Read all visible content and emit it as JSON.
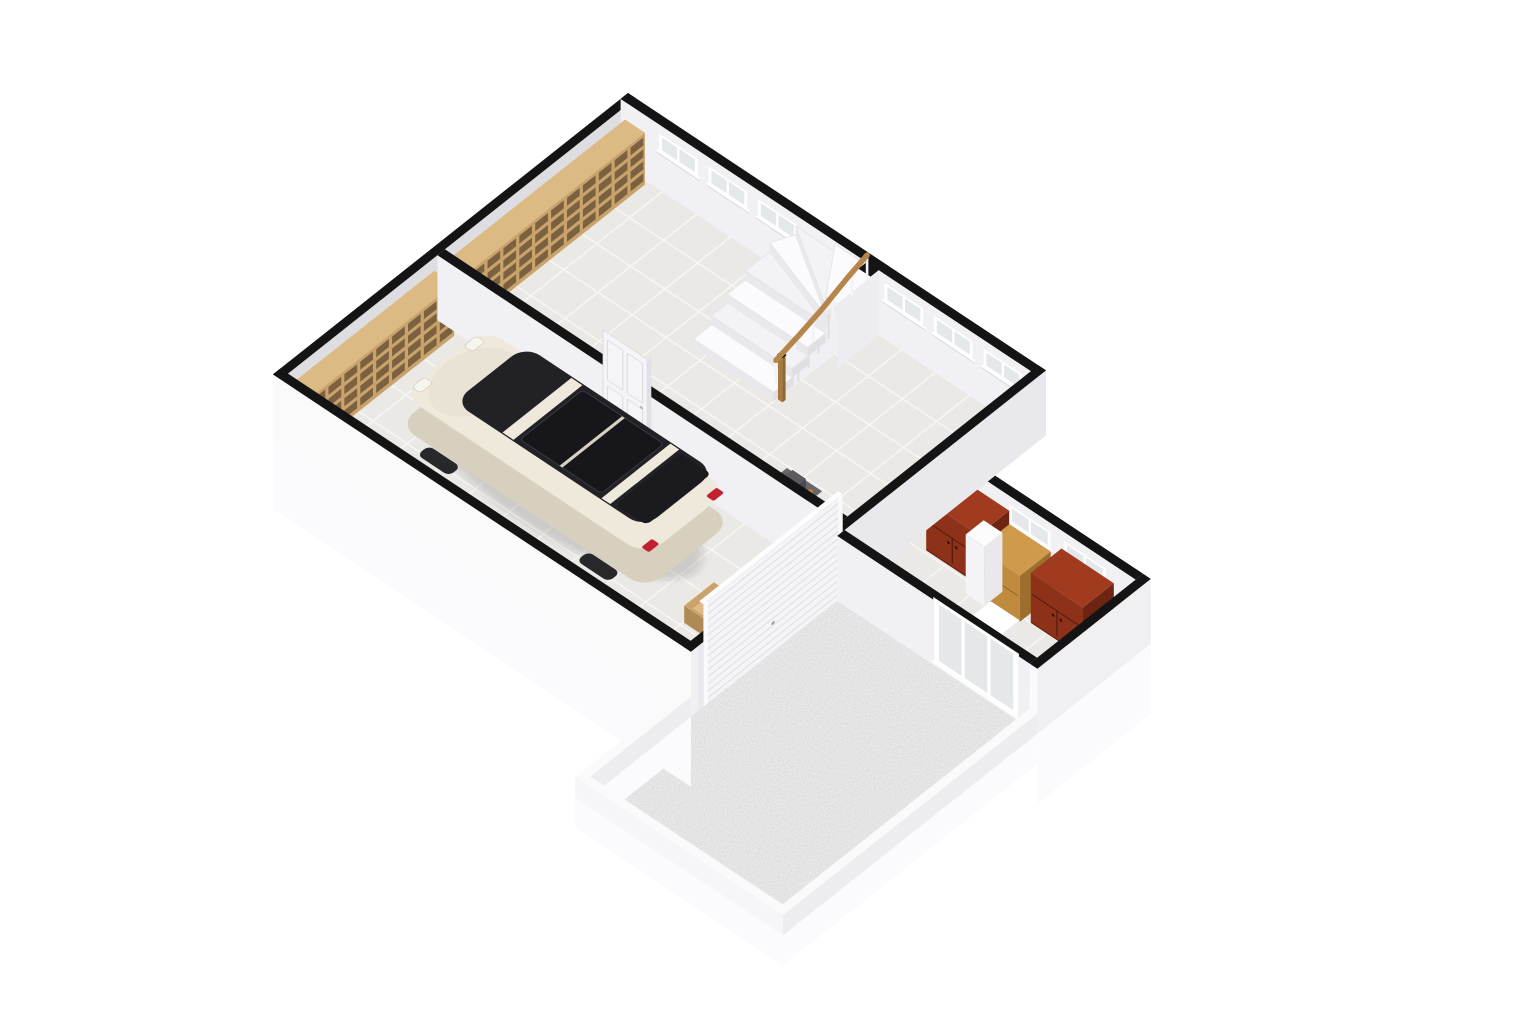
{
  "meta": {
    "label": "3D isometric floor plan render - basement level with garage, hall staircase, storage room and gravel courtyard"
  },
  "projection": {
    "ox": 628,
    "oy": 158,
    "ux": 0.55,
    "uy": 0.365,
    "vx": -0.53,
    "vy": 0.42,
    "wz": 0.5
  },
  "palette": {
    "bg": "#ffffff",
    "wallTop": "#141414",
    "wallInA": "#dedde2",
    "wallInB": "#f1f0f4",
    "wallInX": "#e9e8ec",
    "wallOutY": "#fafafa",
    "wallOutX": "#f0f0f3",
    "skirt": "#fbfbfd",
    "lowTop": "#fafafb",
    "lowFaceY": "#f6f6f8",
    "lowFaceX": "#ededf0",
    "floor": "#ebe9e6",
    "grout": "#f8f7f4",
    "gravelBase": "#e4e4e4",
    "gravelDot": "#8c8c8f",
    "wood": "#c9a36b",
    "woodTop": "#dcba84",
    "woodDark": "#7b6140",
    "woodSide": "#b08a54",
    "crateIn": "#ddbb88",
    "oakTop": "#cf9a4b",
    "oakFront": "#c08b3c",
    "oakSide": "#9c6f2e",
    "redTop": "#a03b20",
    "redFront": "#8e3119",
    "redSide": "#6e2412",
    "redSeam": "#571c0e",
    "doorWhite": "#f5f5f8",
    "doorLine": "#d8d8dd",
    "stairTread": "#fbfbfd",
    "stairTread2": "#f3f3f6",
    "stairRiser": "#e9e9ed",
    "stairSide": "#dfdfe4",
    "stairPanel": "#f0f0f4",
    "rail": "#b5854a",
    "newel": "#a87a3e",
    "carBody": "#efe9dc",
    "carLower": "#d8d0bf",
    "carGlass": "#212126",
    "carGlass2": "#17171b",
    "carShadow": "rgba(40,40,45,0.16)",
    "tail": "#c3212f",
    "metal": "#b9bac0",
    "metalDark": "#8e8f95",
    "tableTop": "#66666b",
    "white": "#ffffff",
    "paneGlass": "#e4e8eb",
    "pillarTop": "#fcfcfd",
    "pillarX": "#e9e9ed",
    "pillarY": "#f4f4f7"
  },
  "scene": {
    "floors": [
      {
        "name": "hall-floor",
        "kind": "tile",
        "x": [
          14,
          746
        ],
        "y": [
          14,
          360
        ]
      },
      {
        "name": "garage-floor",
        "kind": "tile",
        "x": [
          14,
          746
        ],
        "y": [
          374,
          656
        ]
      },
      {
        "name": "storage-floor",
        "kind": "tile",
        "x": [
          760,
          1110
        ],
        "y": [
          194,
          380
        ]
      },
      {
        "name": "courtyard-gravel",
        "kind": "gravel",
        "x": [
          760,
          1110
        ],
        "y": [
          394,
          860
        ]
      }
    ],
    "walls": [
      {
        "name": "exterior-wall-left",
        "axis": "x",
        "x": [
          0,
          14
        ],
        "y": [
          0,
          670
        ],
        "h": 130,
        "face": "wallInA",
        "cap": "wallOutY"
      },
      {
        "name": "exterior-wall-top",
        "axis": "y",
        "y": [
          0,
          14
        ],
        "x": [
          0,
          760
        ],
        "h": 130,
        "face": "wallInB",
        "cap": "wallInX",
        "windows": [
          [
            70,
            140
          ],
          [
            160,
            230
          ],
          [
            250,
            320
          ],
          [
            480,
            550
          ],
          [
            570,
            640
          ],
          [
            660,
            730
          ]
        ],
        "winZ": [
          78,
          112
        ]
      },
      {
        "name": "interior-wall-hall-garage",
        "axis": "y",
        "y": [
          360,
          374
        ],
        "x": [
          14,
          746
        ],
        "h": 130,
        "face": "wallInB"
      },
      {
        "name": "storage-wall-north",
        "axis": "y",
        "y": [
          180,
          194
        ],
        "x": [
          760,
          1110
        ],
        "h": 130,
        "face": "wallInB",
        "windows": [
          [
            880,
            955
          ],
          [
            980,
            1055
          ]
        ],
        "winZ": [
          78,
          112
        ]
      },
      {
        "name": "wall-east-spine",
        "axis": "x",
        "x": [
          746,
          760
        ],
        "y": [
          0,
          670
        ],
        "h": 130,
        "face": "wallInX",
        "cap": "wallOutY"
      },
      {
        "name": "storage-wall-south",
        "axis": "y",
        "y": [
          380,
          394
        ],
        "x": [
          760,
          1110
        ],
        "h": 130,
        "face": "wallInB"
      },
      {
        "name": "storage-wall-east",
        "axis": "x",
        "x": [
          1110,
          1124
        ],
        "y": [
          180,
          394
        ],
        "h": 130,
        "face": "wallOutX",
        "cap": "wallOutY",
        "skirt": -140
      },
      {
        "name": "garage-front-wall",
        "axis": "y",
        "y": [
          656,
          670
        ],
        "x": [
          0,
          760
        ],
        "h": 130,
        "face": "wallOutY",
        "cap": "wallOutX",
        "skirt": -140
      },
      {
        "name": "courtyard-wall-west",
        "axis": "x",
        "x": [
          746,
          760
        ],
        "y": [
          670,
          860
        ],
        "h": 40,
        "face": "lowFaceX",
        "top": "lowTop",
        "skirt": -60
      },
      {
        "name": "courtyard-wall-south",
        "axis": "y",
        "y": [
          860,
          874
        ],
        "x": [
          746,
          1124
        ],
        "h": 40,
        "face": "lowFaceY",
        "top": "lowTop",
        "skirt": -60
      },
      {
        "name": "courtyard-wall-east",
        "axis": "x",
        "x": [
          1110,
          1124
        ],
        "y": [
          394,
          874
        ],
        "h": 40,
        "face": "lowFaceX",
        "top": "lowTop",
        "skirt": -60
      }
    ],
    "furniture": {
      "hall-shelving": {
        "type": "shelf",
        "x": [
          14,
          50
        ],
        "y": [
          20,
          350
        ],
        "h": 104,
        "rows": 4,
        "cols": 11
      },
      "garage-shelving": {
        "type": "shelf",
        "x": [
          14,
          50
        ],
        "y": [
          380,
          650
        ],
        "h": 104,
        "rows": 4,
        "cols": 9
      },
      "staircase": {
        "type": "stairs",
        "straight": [
          {
            "r": [
              302,
              152,
              448,
              190
            ],
            "z": 18
          },
          {
            "r": [
              302,
              122,
              448,
              156
            ],
            "z": 36
          },
          {
            "r": [
              302,
              92,
              448,
              126
            ],
            "z": 54
          }
        ],
        "fan": [
          {
            "pts": [
              [
                448,
                92
              ],
              [
                302,
                92
              ],
              [
                302,
                46
              ]
            ],
            "z": 72
          },
          {
            "pts": [
              [
                448,
                92
              ],
              [
                302,
                46
              ],
              [
                318,
                14
              ]
            ],
            "z": 90
          },
          {
            "pts": [
              [
                448,
                92
              ],
              [
                318,
                14
              ],
              [
                390,
                14
              ]
            ],
            "z": 108
          },
          {
            "pts": [
              [
                448,
                92
              ],
              [
                390,
                14
              ],
              [
                448,
                14
              ]
            ],
            "z": 124
          }
        ],
        "landing": {
          "r": [
            448,
            14,
            470,
            92
          ],
          "z": 130
        },
        "notch": [
          448,
          14,
          470,
          30
        ],
        "rail": [
          [
            454,
            192,
            88
          ],
          [
            454,
            148,
            102
          ],
          [
            454,
            104,
            118
          ],
          [
            454,
            56,
            140
          ],
          [
            454,
            20,
            154
          ]
        ]
      },
      "hall-boxes": {
        "type": "boxes",
        "items": [
          {
            "r": [
              215,
              328,
              243,
              354
            ],
            "h": 28
          },
          {
            "r": [
              246,
              336,
              272,
              360
            ],
            "h": 22
          }
        ]
      },
      "work-table": {
        "type": "table",
        "r": [
          578,
          300,
          642,
          344
        ],
        "h": 54
      },
      "stepladder": {
        "type": "ladder",
        "x1": 676,
        "x2": 702,
        "yBase": 330,
        "yTop": 358,
        "h": 126,
        "rungs": 5
      },
      "interior-door": {
        "type": "door",
        "y": 374,
        "x": [
          315,
          395
        ],
        "h": 200
      },
      "car": {
        "type": "car",
        "r": [
          125,
          400,
          570,
          558
        ]
      },
      "wooden-crate": {
        "type": "crate",
        "r": [
          636,
          498,
          714,
          554
        ],
        "h": 34
      },
      "red-cabinet-1": {
        "type": "cabinet",
        "r": [
          785,
          194,
          880,
          252
        ],
        "h": 100,
        "cols": {
          "top": "redTop",
          "front": "redFront",
          "side": "redSide",
          "seam": "redSeam"
        },
        "doors": true
      },
      "oak-cabinet": {
        "type": "cabinet",
        "r": [
          892,
          206,
          967,
          264
        ],
        "h": 92,
        "cols": {
          "top": "oakTop",
          "front": "oakFront",
          "side": "oakSide",
          "seam": "9c6f2e"
        },
        "doors": false
      },
      "red-cabinet-2": {
        "type": "cabinet",
        "r": [
          979,
          198,
          1074,
          256
        ],
        "h": 100,
        "cols": {
          "top": "redTop",
          "front": "redFront",
          "side": "redSide",
          "seam": "redSeam"
        },
        "doors": true
      },
      "column": {
        "type": "cube",
        "r": [
          878,
          240,
          912,
          274
        ],
        "h": 118,
        "cols": {
          "top": "pillarTop",
          "px": "pillarX",
          "py": "pillarY"
        }
      },
      "step-block": {
        "type": "cube",
        "r": [
          920,
          270,
          972,
          306
        ],
        "h": 12,
        "cols": {
          "top": "white",
          "px": "pillarX",
          "py": "pillarY"
        }
      },
      "garage-door": {
        "type": "gdoor",
        "x": 760,
        "y": [
          384,
          646
        ],
        "h": 205
      },
      "courtyard-window": {
        "type": "cwin",
        "y": 394,
        "x": [
          935,
          1090
        ],
        "z": [
          8,
          135
        ]
      }
    },
    "draw_order": [
      "hall-floor",
      "garage-floor",
      "storage-floor",
      "exterior-wall-left",
      "exterior-wall-top",
      "hall-shelving",
      "garage-shelving",
      "staircase",
      "hall-boxes",
      "work-table",
      "stepladder",
      "interior-wall-hall-garage",
      "interior-door",
      "car",
      "wooden-crate",
      "storage-wall-north",
      "red-cabinet-1",
      "oak-cabinet",
      "red-cabinet-2",
      "column",
      "step-block",
      "wall-east-spine",
      "garage-door",
      "courtyard-gravel",
      "storage-wall-south",
      "courtyard-window",
      "storage-wall-east",
      "garage-front-wall",
      "courtyard-wall-west",
      "courtyard-wall-south",
      "courtyard-wall-east"
    ]
  }
}
